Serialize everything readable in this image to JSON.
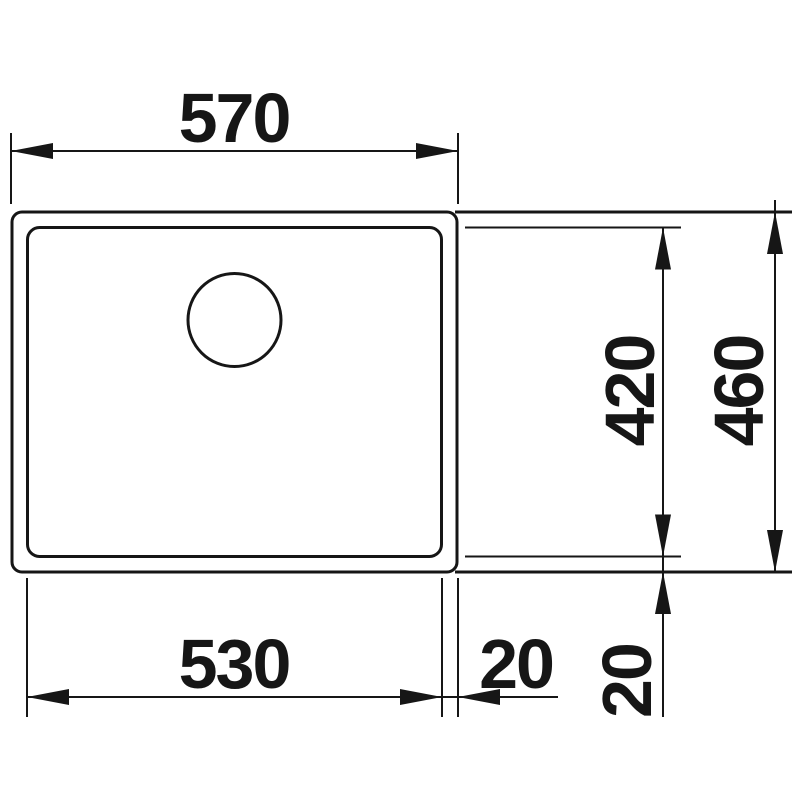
{
  "figure": {
    "type": "technical-dimension-drawing",
    "background_color": "#ffffff",
    "line_color": "#161616",
    "dim_labels": {
      "outer_width": "570",
      "inner_width": "530",
      "inner_height": "420",
      "outer_height": "460",
      "rim_right": "20",
      "rim_bottom": "20"
    }
  }
}
